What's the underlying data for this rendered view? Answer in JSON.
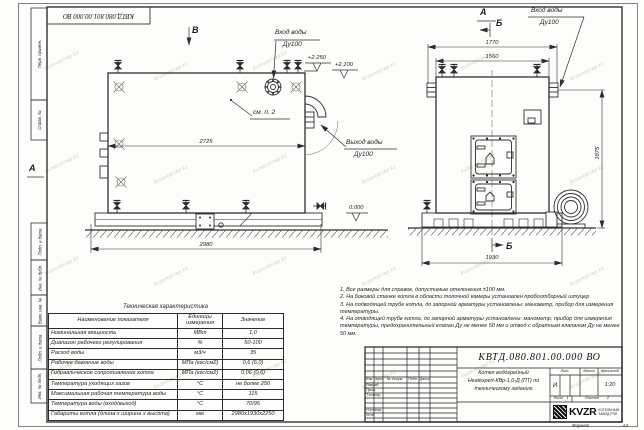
{
  "watermark": {
    "text": "kvzavod-rep.kz"
  },
  "frame": {
    "stamp_top": "КВТД.080.801.00.000 ВО",
    "side_labels": [
      "Перв. примен.",
      "Справ. №",
      "Подп. и дата",
      "Инв. № дубл.",
      "Взам. инв. №",
      "Подп. и дата",
      "Инв. № подл."
    ],
    "format_label": "Формат",
    "format_value": "А3"
  },
  "views": {
    "side": {
      "view_letter": "В",
      "left_letter": "А",
      "inlet_line1": "Вход воды",
      "inlet_line2": "Ду100",
      "outlet_line1": "Выход воды",
      "outlet_line2": "Ду100",
      "see_note": "см. п. 2",
      "level_top": "+2.250",
      "level_top2": "+2.100",
      "level_zero": "0.000",
      "dim_width_top": "2725",
      "dim_width_base": "2980"
    },
    "front": {
      "view_letter": "А",
      "section_letter_top": "Б",
      "section_letter_bottom": "Б",
      "inlet_line1": "Вход воды",
      "inlet_line2": "Ду100",
      "dim_flange": "1770",
      "dim_body": "1560",
      "dim_height": "1875",
      "dim_base": "1930"
    }
  },
  "notes": [
    "1. Все размеры для справок, допустимые отклонения ±100 мм.",
    "2. На боковой стенке котла в области топочной камеры установлен пробоотборный штуцер",
    "3. На подводящей трубе котла, до запорной арматуры установлены: манометр, прибор для измерения температуры.",
    "4. На отводящей трубе котла, до запорной арматуры установлены: манометр, прибор для измерения температуры, предохранительный клапан Ду не менее 50 мм и отвод с обратным клапаном Ду не менее 50 мм."
  ],
  "tech_table": {
    "title": "Техническая характеристика",
    "headers": [
      "Наименование показателя",
      "Единицы измерения",
      "Значение"
    ],
    "rows": [
      [
        "Номинальная мощность",
        "МВт",
        "1,0"
      ],
      [
        "Диапазон рабочего регулирования",
        "%",
        "50-100"
      ],
      [
        "Расход воды",
        "м3/ч",
        "35"
      ],
      [
        "Рабочее давление воды",
        "МПа (кгс/см2)",
        "0,6 (6,0)"
      ],
      [
        "Гидравлическое сопротивление котла",
        "МПа (кгс/см2)",
        "0,06 (0,6)"
      ],
      [
        "Температура уходящих газов",
        "°С",
        "не более 250"
      ],
      [
        "Максимальная рабочая температура воды",
        "°С",
        "115"
      ],
      [
        "Температура воды (вход/выход)",
        "°С",
        "70/95"
      ],
      [
        "Габариты котла (длина х ширина х высота)",
        "мм",
        "2980х1930х2250"
      ]
    ]
  },
  "title_block": {
    "doc_number": "КВТД.080.801.00.000 ВО",
    "title_line1": "Котел водогрейный",
    "title_line2": "Heatexpert-КВр-1,0-Д (ПТ) по",
    "title_line3": "техническому заданию",
    "col_izm": "Изм.",
    "col_list": "Лист",
    "col_doc": "№ докум.",
    "col_podp": "Подп.",
    "col_data": "Дата",
    "row_razrab": "Разраб.",
    "row_prov": "Пров.",
    "row_tkontr": "Т.контр.",
    "row_nkontr": "Н.контр.",
    "row_utv": "Утв.",
    "lit_header": "Лит.",
    "lit_value": "И",
    "mass_header": "Масса",
    "scale_header": "Масштаб",
    "scale_value": "1:20",
    "sheet_label": "Лист",
    "sheet_value": "1",
    "sheets_label": "Листов",
    "sheets_value": "2",
    "logo_word": "KVZR",
    "logo_sub1": "КОТЕЛЬНЫЙ",
    "logo_sub2": "ЗАВОД РЭП"
  }
}
